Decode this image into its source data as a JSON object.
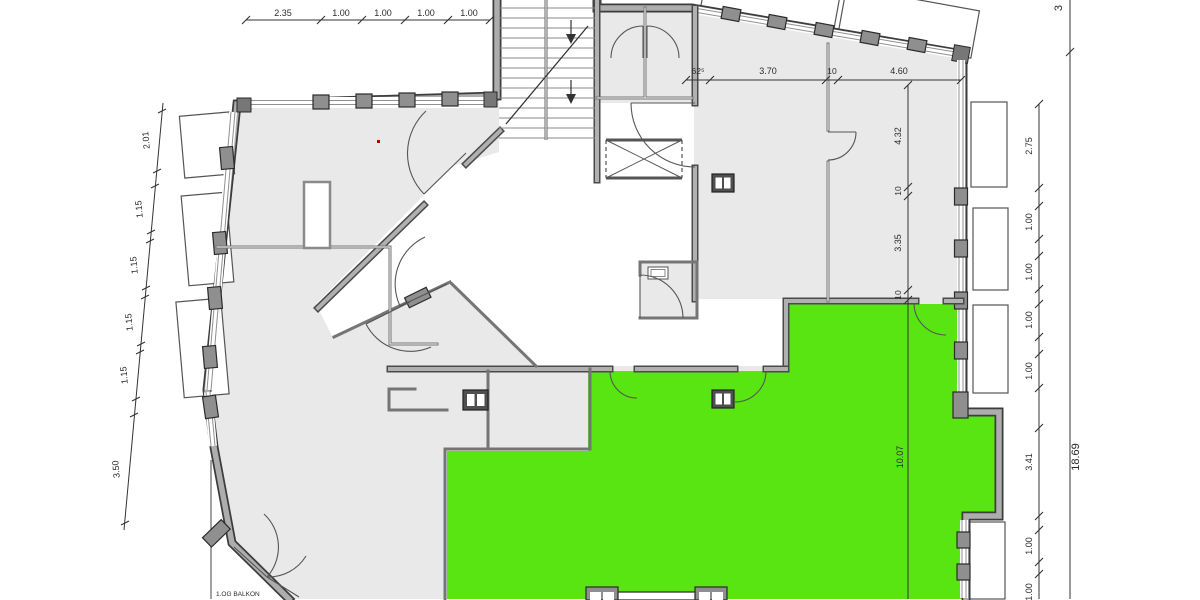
{
  "meta": {
    "drawing_type": "architectural floor plan, first upper storey",
    "background": "#ffffff",
    "room_fill": "#e9e9e9",
    "highlight_color": "#59e512",
    "wall_color": "#adadad",
    "dimension_color": "#2b2b2b"
  },
  "labels": {
    "balcony": "1.OG BALKON"
  },
  "dimensions": {
    "top_chain": [
      "2.35",
      "1.00",
      "1.00",
      "1.00",
      "1.00"
    ],
    "left_chain": [
      "2.01",
      "1.15",
      "1.15",
      "1.15",
      "1.15",
      "3.50"
    ],
    "upper_room_chain": [
      "62⁵",
      "3.70",
      "10",
      "4.60"
    ],
    "right_room_chain": [
      "4.32",
      "10",
      "3.35",
      "10",
      "10.07"
    ],
    "right_outer_chain": [
      "2.75",
      "1.00",
      "1.00",
      "1.00",
      "1.00",
      "3.41",
      "1.00",
      "1.00"
    ],
    "totals": [
      "3",
      "18.69"
    ]
  },
  "annotations": [
    {
      "name": "dim-top-1",
      "text": "2.35",
      "x": 283,
      "y": 16,
      "rot": 0,
      "size": 9
    },
    {
      "name": "dim-top-2",
      "text": "1.00",
      "x": 341,
      "y": 16,
      "rot": 0,
      "size": 9
    },
    {
      "name": "dim-top-3",
      "text": "1.00",
      "x": 383,
      "y": 16,
      "rot": 0,
      "size": 9
    },
    {
      "name": "dim-top-4",
      "text": "1.00",
      "x": 426,
      "y": 16,
      "rot": 0,
      "size": 9
    },
    {
      "name": "dim-top-5",
      "text": "1.00",
      "x": 469,
      "y": 16,
      "rot": 0,
      "size": 9
    },
    {
      "name": "dim-left-1",
      "text": "2.01",
      "x": 149,
      "y": 140,
      "rot": -95,
      "size": 9
    },
    {
      "name": "dim-left-2",
      "text": "1.15",
      "x": 142,
      "y": 209,
      "rot": -95,
      "size": 9
    },
    {
      "name": "dim-left-3",
      "text": "1.15",
      "x": 137,
      "y": 265,
      "rot": -95,
      "size": 9
    },
    {
      "name": "dim-left-4",
      "text": "1.15",
      "x": 132,
      "y": 322,
      "rot": -95,
      "size": 9
    },
    {
      "name": "dim-left-5",
      "text": "1.15",
      "x": 127,
      "y": 375,
      "rot": -95,
      "size": 9
    },
    {
      "name": "dim-left-6",
      "text": "3.50",
      "x": 119,
      "y": 469,
      "rot": -95,
      "size": 9
    },
    {
      "name": "dim-room-1",
      "text": "62⁵",
      "x": 698,
      "y": 74,
      "rot": 0,
      "size": 8.5
    },
    {
      "name": "dim-room-2",
      "text": "3.70",
      "x": 768,
      "y": 74,
      "rot": 0,
      "size": 9
    },
    {
      "name": "dim-room-3",
      "text": "10",
      "x": 832,
      "y": 74,
      "rot": 0,
      "size": 8.5
    },
    {
      "name": "dim-room-4",
      "text": "4.60",
      "x": 899,
      "y": 74,
      "rot": 0,
      "size": 9
    },
    {
      "name": "dim-rroom-1",
      "text": "4.32",
      "x": 901,
      "y": 136,
      "rot": -90,
      "size": 9
    },
    {
      "name": "dim-rroom-2",
      "text": "10",
      "x": 901,
      "y": 191,
      "rot": -90,
      "size": 8.5
    },
    {
      "name": "dim-rroom-3",
      "text": "3.35",
      "x": 901,
      "y": 243,
      "rot": -90,
      "size": 9
    },
    {
      "name": "dim-rroom-4",
      "text": "10",
      "x": 901,
      "y": 295,
      "rot": -90,
      "size": 8.5
    },
    {
      "name": "dim-green-height",
      "text": "10.07",
      "x": 903,
      "y": 457,
      "rot": -90,
      "size": 9,
      "color": "#a0a0a0"
    },
    {
      "name": "dim-right-1",
      "text": "2.75",
      "x": 1032,
      "y": 146,
      "rot": -90,
      "size": 9
    },
    {
      "name": "dim-right-2",
      "text": "1.00",
      "x": 1032,
      "y": 222,
      "rot": -90,
      "size": 9
    },
    {
      "name": "dim-right-3",
      "text": "1.00",
      "x": 1032,
      "y": 272,
      "rot": -90,
      "size": 9
    },
    {
      "name": "dim-right-4",
      "text": "1.00",
      "x": 1032,
      "y": 320,
      "rot": -90,
      "size": 9
    },
    {
      "name": "dim-right-5",
      "text": "1.00",
      "x": 1032,
      "y": 371,
      "rot": -90,
      "size": 9
    },
    {
      "name": "dim-right-6",
      "text": "3.41",
      "x": 1032,
      "y": 462,
      "rot": -90,
      "size": 9
    },
    {
      "name": "dim-right-7",
      "text": "1.00",
      "x": 1032,
      "y": 546,
      "rot": -90,
      "size": 9
    },
    {
      "name": "dim-right-8",
      "text": "1.00",
      "x": 1032,
      "y": 592,
      "rot": -90,
      "size": 9
    },
    {
      "name": "dim-total-partial",
      "text": "3",
      "x": 1062,
      "y": 8,
      "rot": -90,
      "size": 11
    },
    {
      "name": "dim-total",
      "text": "18.69",
      "x": 1079,
      "y": 457,
      "rot": -90,
      "size": 11
    },
    {
      "name": "balcony-label",
      "text": "1.OG BALKON",
      "x": 216,
      "y": 596,
      "rot": 0,
      "size": 6.5,
      "anchor": "start"
    }
  ]
}
